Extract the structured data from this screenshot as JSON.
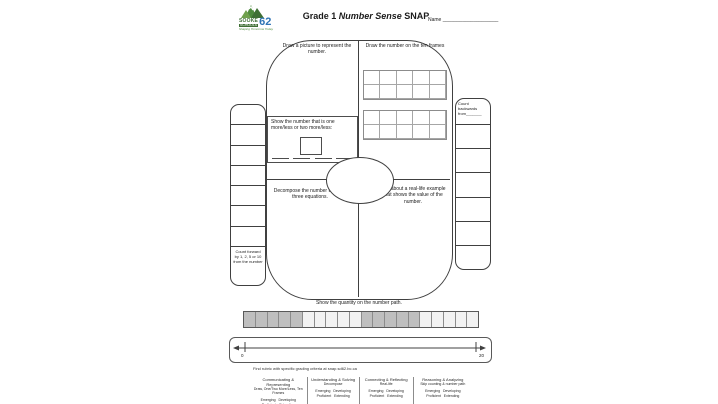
{
  "header": {
    "logo": {
      "sooke": "SOOKE",
      "schools": "SCHOOLS",
      "number": "62",
      "tagline": "Shaping Tomorrow Today",
      "green": "#3f6f34",
      "blue": "#2e74b5"
    },
    "title_prefix": "Grade 1 ",
    "title_italic": "Number Sense",
    "title_suffix": " SNAP",
    "name_label": "Name ____________________"
  },
  "snap": {
    "draw_picture": "Draw a picture to represent the number.",
    "draw_ten_frames": "Draw the number on the ten frames",
    "more_less_label": "Show the number that is one more/less or two more/less:",
    "decompose": "Decompose the number to make three equations.",
    "real_life": "Talk about a real-life example that shows the value of the number.",
    "number_path_caption": "Show the quantity on the number path.",
    "ten_frame": {
      "frames": 2,
      "rows": 2,
      "cols": 5
    }
  },
  "left_panel": {
    "label": "Count forward by 1, 2, 5 or 10 from the number",
    "cell_count": 7
  },
  "right_panel": {
    "label": "Count backwards from_______",
    "cell_count": 6
  },
  "number_path": {
    "cells": [
      1,
      1,
      1,
      1,
      1,
      0,
      0,
      0,
      0,
      0,
      1,
      1,
      1,
      1,
      1,
      0,
      0,
      0,
      0,
      0
    ],
    "shaded_color": "#bfbfbf",
    "unshaded_color": "#f2f2f2"
  },
  "number_line": {
    "min": "0",
    "max": "20"
  },
  "footer": {
    "note": "Find rubric with specific grading criteria at snap.sd62.bc.ca",
    "rubric": [
      {
        "title": "Communicating & Representing",
        "skills": "Draw, One/Two More/Less, Ten Frames",
        "levels1": "Emerging   Developing",
        "levels2": "Proficient   Extending"
      },
      {
        "title": "Understanding & Solving",
        "skills": "Decompose",
        "levels1": "Emerging   Developing",
        "levels2": "Proficient   Extending"
      },
      {
        "title": "Connecting & Reflecting",
        "skills": "Real-life",
        "levels1": "Emerging   Developing",
        "levels2": "Proficient   Extending"
      },
      {
        "title": "Reasoning & Analyzing",
        "skills": "Skip counting & number path",
        "levels1": "Emerging   Developing",
        "levels2": "Proficient   Extending"
      }
    ]
  }
}
